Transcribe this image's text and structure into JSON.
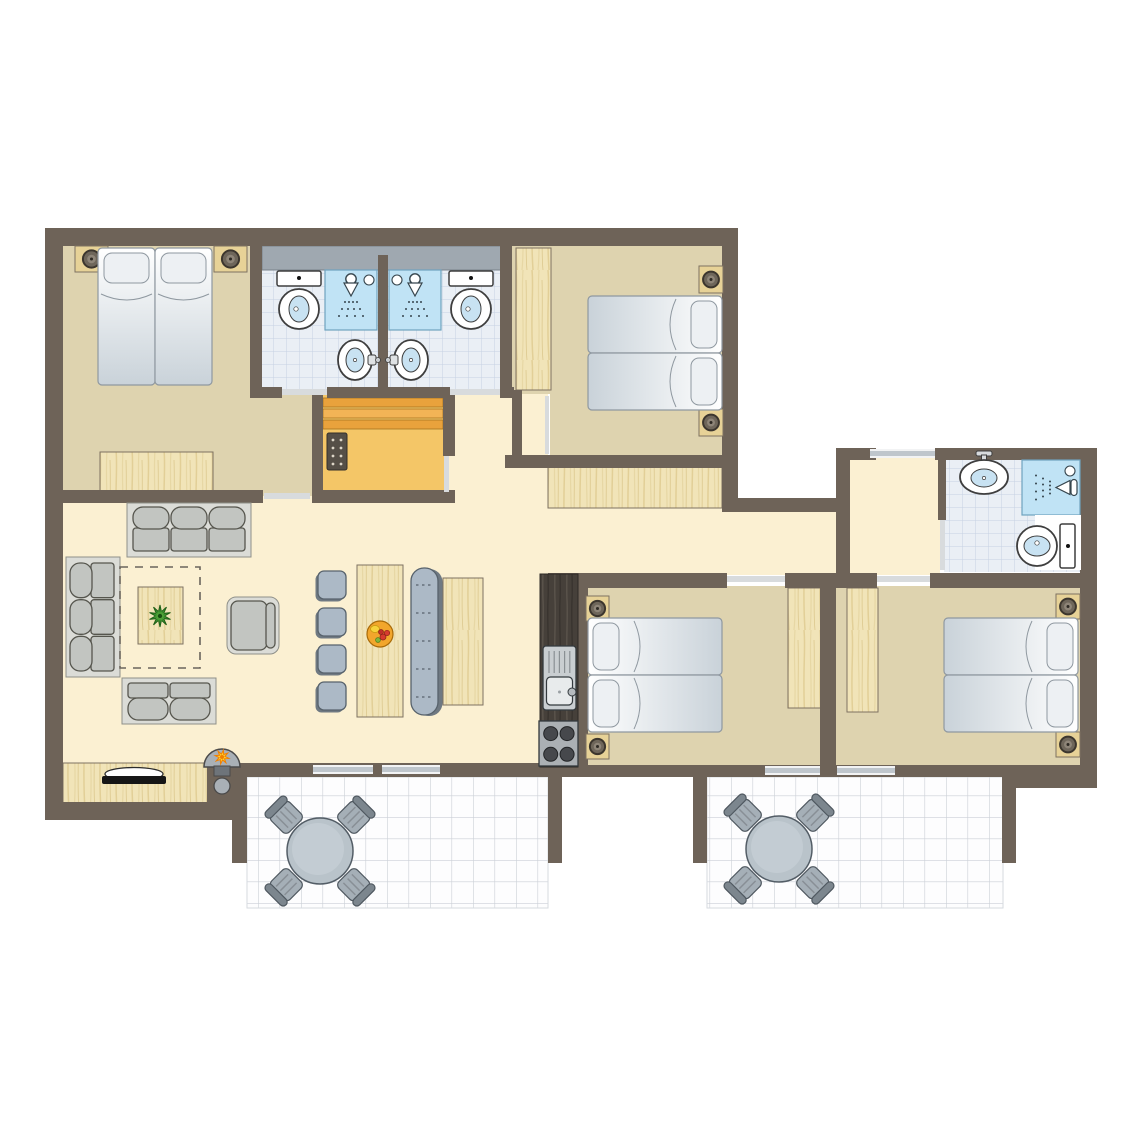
{
  "canvas": {
    "width": 1145,
    "height": 1145,
    "background": "#FFFFFF"
  },
  "plan_type": "holiday-home-floor-plan",
  "palette": {
    "wall": "#6E6358",
    "cream": "#FBF0D2",
    "tan": "#DED3AF",
    "sauna": "#F4C667",
    "saunaBench1": "#E9A23C",
    "saunaBench2": "#F2B456",
    "bedEdge": "#8F98A0",
    "pillow": "#EDF0F3",
    "sofaFrame": "#DBDCD7",
    "cushion": "#C2C5C1",
    "cushionEdge": "#56564E",
    "chair": "#ACB9C6",
    "chairEdge": "#57626C",
    "chairShadow": "#6F7982",
    "woodEdge": "#7E7262",
    "fixtureEdge": "#3E3E3E",
    "water": "#C8E2F2",
    "grayBand": "#9FA8B0",
    "windowFill": "#BFC6CC",
    "doorFill": "#D8DBDD",
    "tileLine": "#C6D2E2",
    "showerBlue": "#C0E3F5",
    "counterDark": "#46403A",
    "tableGray": "#B9C3CA"
  },
  "elements": [
    {
      "t": "rect",
      "n": "living-room-floor",
      "x": 63,
      "y": 490,
      "w": 515,
      "h": 285,
      "f": "$cream"
    },
    {
      "t": "rect",
      "n": "corridor-floor",
      "x": 443,
      "y": 390,
      "w": 105,
      "h": 118,
      "f": "$cream"
    },
    {
      "t": "rect",
      "n": "hallway-floor",
      "x": 548,
      "y": 505,
      "w": 292,
      "h": 70,
      "f": "$cream"
    },
    {
      "t": "rect",
      "n": "right-hall-floor",
      "x": 846,
      "y": 458,
      "w": 94,
      "h": 117,
      "f": "$cream"
    },
    {
      "t": "rect",
      "n": "bedroom1-floor",
      "x": 63,
      "y": 246,
      "w": 200,
      "h": 250,
      "f": "$tan"
    },
    {
      "t": "rect",
      "n": "bedroom1-floor-ext",
      "x": 250,
      "y": 390,
      "w": 68,
      "h": 106,
      "f": "$tan"
    },
    {
      "t": "rect",
      "n": "bedroom2-floor",
      "x": 510,
      "y": 246,
      "w": 214,
      "h": 148,
      "f": "$tan"
    },
    {
      "t": "rect",
      "n": "bedroom2-floor-strip",
      "x": 550,
      "y": 388,
      "w": 174,
      "h": 70,
      "f": "$tan"
    },
    {
      "t": "rect",
      "n": "bedroom3-floor",
      "x": 586,
      "y": 586,
      "w": 236,
      "h": 182,
      "f": "$tan"
    },
    {
      "t": "rect",
      "n": "bedroom4-floor",
      "x": 834,
      "y": 586,
      "w": 248,
      "h": 182,
      "f": "$tan"
    },
    {
      "t": "rect",
      "n": "bathrooms-top-floor",
      "x": 262,
      "y": 258,
      "w": 240,
      "h": 131,
      "f": "@tile"
    },
    {
      "t": "rect",
      "n": "bathroom-wing-floor",
      "x": 944,
      "y": 458,
      "w": 138,
      "h": 114,
      "f": "@tile"
    },
    {
      "t": "rect",
      "n": "sauna-floor",
      "x": 318,
      "y": 393,
      "w": 128,
      "h": 100,
      "f": "$sauna"
    },
    {
      "t": "rect",
      "n": "terrace-1-floor",
      "x": 247,
      "y": 777,
      "w": 301,
      "h": 131,
      "f": "@terr",
      "s": "#D6DADF",
      "sw": 1
    },
    {
      "t": "rect",
      "n": "terrace-2-floor",
      "x": 707,
      "y": 777,
      "w": 296,
      "h": 131,
      "f": "@terr",
      "s": "#D6DADF",
      "sw": 1
    },
    {
      "t": "wood",
      "n": "hall-closet",
      "x": 548,
      "y": 466,
      "w": 174,
      "h": 42
    },
    {
      "t": "wood",
      "n": "bedroom2-wardrobe",
      "x": 516,
      "y": 248,
      "w": 35,
      "h": 142
    },
    {
      "t": "wood",
      "n": "bedroom1-dresser",
      "x": 100,
      "y": 452,
      "w": 113,
      "h": 39
    },
    {
      "t": "wood",
      "n": "bedroom3-wardrobe",
      "x": 788,
      "y": 588,
      "w": 33,
      "h": 120
    },
    {
      "t": "wood",
      "n": "bedroom4-wardrobe",
      "x": 847,
      "y": 588,
      "w": 31,
      "h": 124
    },
    {
      "t": "wood",
      "n": "tv-sideboard",
      "x": 63,
      "y": 763,
      "w": 145,
      "h": 42
    },
    {
      "t": "sbench",
      "n": "sauna-benches",
      "x": 323,
      "y": 398,
      "w": 120
    },
    {
      "t": "panel",
      "n": "sauna-control-panel",
      "x": 327,
      "y": 433,
      "w": 20,
      "h": 37
    },
    {
      "t": "band",
      "n": "bathroom-window-band",
      "x": 262,
      "y": 246,
      "w": 240,
      "h": 24
    },
    {
      "t": "wall",
      "n": "wall-top",
      "x": 45,
      "y": 228,
      "w": 692,
      "h": 18
    },
    {
      "t": "wall",
      "n": "wall-left",
      "x": 45,
      "y": 228,
      "w": 18,
      "h": 592
    },
    {
      "t": "wall",
      "n": "wall-bottom-left",
      "x": 45,
      "y": 802,
      "w": 192,
      "h": 18
    },
    {
      "t": "wall",
      "n": "wall-bedroom1-south",
      "x": 45,
      "y": 490,
      "w": 218,
      "h": 13
    },
    {
      "t": "wall",
      "n": "wall-bath-left",
      "x": 250,
      "y": 246,
      "w": 12,
      "h": 144
    },
    {
      "t": "wall",
      "n": "wall-bath-divider",
      "x": 378,
      "y": 255,
      "w": 10,
      "h": 134
    },
    {
      "t": "wall",
      "n": "wall-bath-right",
      "x": 500,
      "y": 246,
      "w": 12,
      "h": 144
    },
    {
      "t": "wall",
      "n": "wall-bath-south-a",
      "x": 250,
      "y": 387,
      "w": 32,
      "h": 11
    },
    {
      "t": "wall",
      "n": "wall-bath-south-b",
      "x": 327,
      "y": 387,
      "w": 123,
      "h": 11
    },
    {
      "t": "wall",
      "n": "wall-bath-south-c",
      "x": 500,
      "y": 387,
      "w": 14,
      "h": 11
    },
    {
      "t": "wall",
      "n": "wall-sauna-west",
      "x": 312,
      "y": 393,
      "w": 11,
      "h": 110
    },
    {
      "t": "wall",
      "n": "wall-sauna-east-a",
      "x": 443,
      "y": 393,
      "w": 12,
      "h": 63
    },
    {
      "t": "wall",
      "n": "wall-sauna-east-b",
      "x": 443,
      "y": 492,
      "w": 12,
      "h": 11
    },
    {
      "t": "wall",
      "n": "wall-sauna-south",
      "x": 312,
      "y": 490,
      "w": 143,
      "h": 13
    },
    {
      "t": "wall",
      "n": "wall-bedroom2-stub",
      "x": 512,
      "y": 390,
      "w": 10,
      "h": 68
    },
    {
      "t": "wall",
      "n": "wall-bedroom2-south",
      "x": 505,
      "y": 455,
      "w": 233,
      "h": 13
    },
    {
      "t": "wall",
      "n": "wall-bedroom2-east",
      "x": 722,
      "y": 228,
      "w": 16,
      "h": 272
    },
    {
      "t": "wall",
      "n": "wall-notch-south",
      "x": 722,
      "y": 498,
      "w": 128,
      "h": 14
    },
    {
      "t": "wall",
      "n": "wall-wing-west",
      "x": 836,
      "y": 448,
      "w": 14,
      "h": 125
    },
    {
      "t": "wall",
      "n": "wall-wing-north-a",
      "x": 836,
      "y": 448,
      "w": 40,
      "h": 12
    },
    {
      "t": "wall",
      "n": "wall-wing-north-b",
      "x": 935,
      "y": 448,
      "w": 162,
      "h": 12
    },
    {
      "t": "wall",
      "n": "wall-right",
      "x": 1080,
      "y": 448,
      "w": 17,
      "h": 340
    },
    {
      "t": "wall",
      "n": "wall-wingbath-west",
      "x": 938,
      "y": 458,
      "w": 8,
      "h": 62
    },
    {
      "t": "wall",
      "n": "wall-hall-south-a",
      "x": 548,
      "y": 573,
      "w": 179,
      "h": 15
    },
    {
      "t": "wall",
      "n": "wall-hall-south-b",
      "x": 785,
      "y": 573,
      "w": 92,
      "h": 15
    },
    {
      "t": "wall",
      "n": "wall-hall-south-c",
      "x": 930,
      "y": 573,
      "w": 150,
      "h": 15
    },
    {
      "t": "wall",
      "n": "wall-kitchen",
      "x": 578,
      "y": 573,
      "w": 10,
      "h": 196
    },
    {
      "t": "wall",
      "n": "wall-bedroom34-divider",
      "x": 820,
      "y": 586,
      "w": 16,
      "h": 182
    },
    {
      "t": "wall",
      "n": "wall-living-south",
      "x": 215,
      "y": 763,
      "w": 345,
      "h": 14
    },
    {
      "t": "wall",
      "n": "wall-bottom-right",
      "x": 560,
      "y": 765,
      "w": 537,
      "h": 12
    },
    {
      "t": "wall",
      "n": "wall-corner-se",
      "x": 1013,
      "y": 775,
      "w": 84,
      "h": 13
    },
    {
      "t": "wall",
      "n": "terrace1-stub-west",
      "x": 232,
      "y": 777,
      "w": 15,
      "h": 86
    },
    {
      "t": "wall",
      "n": "terrace1-stub-east",
      "x": 548,
      "y": 777,
      "w": 14,
      "h": 86
    },
    {
      "t": "wall",
      "n": "terrace2-stub-west",
      "x": 693,
      "y": 777,
      "w": 14,
      "h": 86
    },
    {
      "t": "wall",
      "n": "terrace2-stub-east",
      "x": 1002,
      "y": 777,
      "w": 14,
      "h": 86
    },
    {
      "t": "wall",
      "n": "stove-flue-wall",
      "x": 207,
      "y": 763,
      "w": 31,
      "h": 42
    },
    {
      "t": "win",
      "n": "window-living-1",
      "x": 313,
      "y": 765,
      "w": 60,
      "h": 9
    },
    {
      "t": "win",
      "n": "window-living-2",
      "x": 382,
      "y": 765,
      "w": 58,
      "h": 9
    },
    {
      "t": "win",
      "n": "window-bedroom3",
      "x": 765,
      "y": 766,
      "w": 55,
      "h": 9
    },
    {
      "t": "win",
      "n": "window-bedroom4",
      "x": 837,
      "y": 766,
      "w": 58,
      "h": 9
    },
    {
      "t": "win",
      "n": "window-hall",
      "x": 870,
      "y": 449,
      "w": 65,
      "h": 9
    },
    {
      "t": "door",
      "n": "door-bedroom1",
      "x": 264,
      "y": 493,
      "w": 46,
      "h": 6
    },
    {
      "t": "door",
      "n": "door-bathroom-left",
      "x": 282,
      "y": 389,
      "w": 45,
      "h": 6
    },
    {
      "t": "door",
      "n": "door-bathroom-right",
      "x": 450,
      "y": 389,
      "w": 50,
      "h": 6
    },
    {
      "t": "door",
      "n": "door-bedroom2",
      "x": 545,
      "y": 396,
      "w": 4,
      "h": 58
    },
    {
      "t": "door",
      "n": "door-sauna",
      "x": 444,
      "y": 456,
      "w": 5,
      "h": 36
    },
    {
      "t": "door",
      "n": "door-bedroom3",
      "x": 727,
      "y": 576,
      "w": 58,
      "h": 6
    },
    {
      "t": "door",
      "n": "door-bedroom4",
      "x": 877,
      "y": 576,
      "w": 53,
      "h": 6
    },
    {
      "t": "door",
      "n": "door-bathroom-wing",
      "x": 940,
      "y": 520,
      "w": 5,
      "h": 50
    },
    {
      "t": "toiletD",
      "n": "toilet",
      "x": 274,
      "y": 271
    },
    {
      "t": "shower",
      "n": "shower",
      "x": 325,
      "y": 270,
      "w": 52,
      "h": 60,
      "dir": "d",
      "vx": 44,
      "vy": 10
    },
    {
      "t": "sinkP",
      "n": "washbasin",
      "cx": 355,
      "cy": 360,
      "dir": "r"
    },
    {
      "t": "shower",
      "n": "shower",
      "x": 389,
      "y": 270,
      "w": 52,
      "h": 60,
      "dir": "d",
      "vx": 8,
      "vy": 10
    },
    {
      "t": "toiletD",
      "n": "toilet",
      "x": 446,
      "y": 271
    },
    {
      "t": "sinkP",
      "n": "washbasin",
      "cx": 411,
      "cy": 360,
      "dir": "l"
    },
    {
      "t": "sinkT",
      "n": "washbasin",
      "cx": 984,
      "cy": 477
    },
    {
      "t": "shower",
      "n": "shower",
      "x": 1022,
      "y": 460,
      "w": 58,
      "h": 55,
      "dir": "l",
      "vx": 48,
      "vy": 11
    },
    {
      "t": "rect",
      "n": "shower-tray",
      "x": 1035,
      "y": 515,
      "w": 46,
      "h": 55,
      "f": "#FFFFFF"
    },
    {
      "t": "toiletL",
      "n": "toilet",
      "cx": 1046,
      "cy": 546
    },
    {
      "t": "ns",
      "n": "nightstand-lamp",
      "x": 75,
      "y": 246,
      "w": 33,
      "h": 26
    },
    {
      "t": "ns",
      "n": "nightstand-lamp",
      "x": 214,
      "y": 246,
      "w": 33,
      "h": 26
    },
    {
      "t": "bedV",
      "n": "single-bed",
      "x": 98,
      "y": 248,
      "w": 57,
      "h": 137
    },
    {
      "t": "bedV",
      "n": "single-bed",
      "x": 155,
      "y": 248,
      "w": 57,
      "h": 137
    },
    {
      "t": "ns",
      "n": "nightstand-lamp",
      "x": 699,
      "y": 266,
      "w": 24,
      "h": 27
    },
    {
      "t": "ns",
      "n": "nightstand-lamp",
      "x": 699,
      "y": 409,
      "w": 24,
      "h": 27
    },
    {
      "t": "bedH",
      "n": "single-bed",
      "x": 588,
      "y": 296,
      "w": 134,
      "h": 57,
      "head": "r"
    },
    {
      "t": "bedH",
      "n": "single-bed",
      "x": 588,
      "y": 353,
      "w": 134,
      "h": 57,
      "head": "r"
    },
    {
      "t": "ns",
      "n": "nightstand-lamp",
      "x": 586,
      "y": 596,
      "w": 23,
      "h": 25
    },
    {
      "t": "ns",
      "n": "nightstand-lamp",
      "x": 586,
      "y": 734,
      "w": 23,
      "h": 25
    },
    {
      "t": "bedH",
      "n": "single-bed",
      "x": 588,
      "y": 618,
      "w": 134,
      "h": 57,
      "head": "l"
    },
    {
      "t": "bedH",
      "n": "single-bed",
      "x": 588,
      "y": 675,
      "w": 134,
      "h": 57,
      "head": "l"
    },
    {
      "t": "ns",
      "n": "nightstand-lamp",
      "x": 1056,
      "y": 594,
      "w": 24,
      "h": 25
    },
    {
      "t": "ns",
      "n": "nightstand-lamp",
      "x": 1056,
      "y": 732,
      "w": 24,
      "h": 25
    },
    {
      "t": "bedH",
      "n": "single-bed",
      "x": 944,
      "y": 618,
      "w": 134,
      "h": 57,
      "head": "r"
    },
    {
      "t": "bedH",
      "n": "single-bed",
      "x": 944,
      "y": 675,
      "w": 134,
      "h": 57,
      "head": "r"
    },
    {
      "t": "sofa",
      "n": "sofa-3-seat",
      "x": 127,
      "y": 503,
      "w": 124,
      "h": 54,
      "back": "t",
      "seats": 3
    },
    {
      "t": "sofa",
      "n": "sofa-3-seat",
      "x": 66,
      "y": 557,
      "w": 54,
      "h": 120,
      "back": "l",
      "seats": 3
    },
    {
      "t": "sofa",
      "n": "sofa-2-seat",
      "x": 122,
      "y": 678,
      "w": 94,
      "h": 46,
      "back": "b",
      "seats": 2
    },
    {
      "t": "arm",
      "n": "armchair",
      "x": 227,
      "y": 597,
      "w": 52,
      "h": 57
    },
    {
      "t": "rug",
      "n": "rug",
      "x": 120,
      "y": 567,
      "w": 80,
      "h": 101
    },
    {
      "t": "wood",
      "n": "coffee-table",
      "x": 138,
      "y": 587,
      "w": 45,
      "h": 57
    },
    {
      "t": "plant",
      "n": "plant",
      "cx": 160,
      "cy": 616
    },
    {
      "t": "tv",
      "n": "tv",
      "cx": 134,
      "cy": 779
    },
    {
      "t": "wstove",
      "n": "wood-stove",
      "cx": 222,
      "by": 767
    },
    {
      "t": "cwall",
      "n": "flue-outlet",
      "cx": 222,
      "cy": 786,
      "r": 8
    },
    {
      "t": "chair",
      "n": "dining-chair",
      "x": 318,
      "y": 571,
      "w": 28,
      "h": 28
    },
    {
      "t": "chair",
      "n": "dining-chair",
      "x": 318,
      "y": 608,
      "w": 28,
      "h": 28
    },
    {
      "t": "chair",
      "n": "dining-chair",
      "x": 318,
      "y": 645,
      "w": 28,
      "h": 28
    },
    {
      "t": "chair",
      "n": "dining-chair",
      "x": 318,
      "y": 682,
      "w": 28,
      "h": 28
    },
    {
      "t": "wood",
      "n": "dining-table",
      "x": 357,
      "y": 565,
      "w": 46,
      "h": 152
    },
    {
      "t": "fruit",
      "n": "fruit-bowl",
      "cx": 380,
      "cy": 634
    },
    {
      "t": "bench",
      "n": "dining-bench",
      "x": 411,
      "y": 568,
      "w": 27,
      "h": 147
    },
    {
      "t": "wood",
      "n": "side-table",
      "x": 443,
      "y": 578,
      "w": 40,
      "h": 127
    },
    {
      "t": "counter",
      "n": "kitchen-counter",
      "x": 540,
      "y": 574,
      "w": 38,
      "h": 193
    },
    {
      "t": "ksink",
      "n": "kitchen-sink",
      "x": 543,
      "y": 646,
      "w": 33,
      "h": 64
    },
    {
      "t": "kstove",
      "n": "kitchen-stove",
      "x": 539,
      "y": 721,
      "w": 39,
      "h": 45
    },
    {
      "t": "stable",
      "n": "terrace-table-set",
      "cx": 320,
      "cy": 851
    },
    {
      "t": "stable",
      "n": "terrace-table-set",
      "cx": 779,
      "cy": 849
    }
  ]
}
